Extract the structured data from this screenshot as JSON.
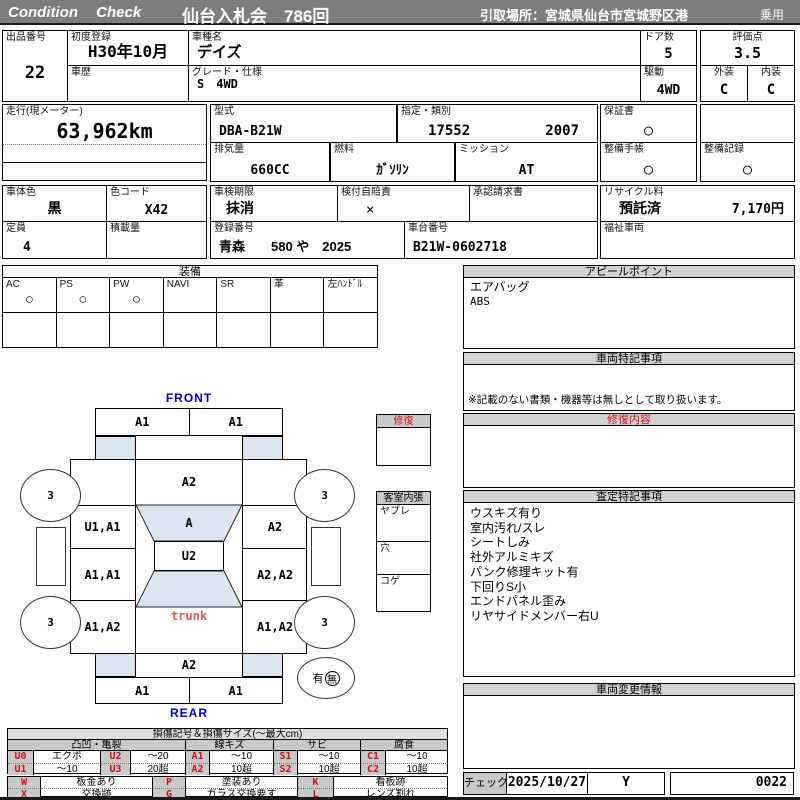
{
  "colors": {
    "header_bg": "#7d7d7d",
    "shade_blue": "#dbe5f1",
    "direction_blue": "#0000cc",
    "accent_red": "#cc1111",
    "cell_gray": "#c9c9c9"
  },
  "header": {
    "brand": "Condition Check",
    "auction": "仙台入札会　786回",
    "pickup": "引取場所：宮城県仙台市宮城野区港",
    "category": "乗用"
  },
  "vehicle": {
    "lot": {
      "label": "出品番号",
      "value": "22"
    },
    "first_registration": {
      "label": "初度登録",
      "value": "H30年10月"
    },
    "model_name": {
      "label": "車種名",
      "value": "デイズ"
    },
    "history": {
      "label": "車歴",
      "value": ""
    },
    "grade": {
      "label": "グレード・仕様",
      "value": "S　4WD"
    },
    "doors": {
      "label": "ドア数",
      "value": "5"
    },
    "score": {
      "label": "評価点",
      "value": "3.5"
    },
    "drive": {
      "label": "駆動",
      "value": "4WD"
    },
    "exterior": {
      "label": "外装",
      "value": "C"
    },
    "interior": {
      "label": "内装",
      "value": "C"
    },
    "mileage": {
      "label": "走行(現メーター)",
      "value": "63,962km"
    },
    "model_code": {
      "label": "型式",
      "value": "DBA-B21W"
    },
    "designation": {
      "label": "指定・類別",
      "value1": "17552",
      "value2": "2007"
    },
    "warranty": {
      "label": "保証書",
      "value": "○"
    },
    "displacement": {
      "label": "排気量",
      "value": "660CC"
    },
    "fuel": {
      "label": "燃料",
      "value": "ｶﾞｿﾘﾝ"
    },
    "mission": {
      "label": "ミッション",
      "value": "AT"
    },
    "maintenance_book": {
      "label": "整備手帳",
      "value": "○"
    },
    "maintenance_record": {
      "label": "整備記録",
      "value": "○"
    },
    "body_color": {
      "label": "車体色",
      "value": "黒"
    },
    "color_code": {
      "label": "色コード",
      "value": "X42"
    },
    "inspection_expiry": {
      "label": "車検期限",
      "value": "抹消"
    },
    "liability_insurance": {
      "label": "検付自賠責",
      "value": "×"
    },
    "approval_request": {
      "label": "承認請求書",
      "value": ""
    },
    "recycle": {
      "label": "リサイクル料",
      "status": "預託済",
      "fee": "7,170円"
    },
    "seating": {
      "label": "定員",
      "value": "4"
    },
    "load_capacity": {
      "label": "積載量",
      "value": ""
    },
    "registration_no": {
      "label": "登録番号",
      "value": "青森　　580 や　2025"
    },
    "chassis_no": {
      "label": "車台番号",
      "value": "B21W-0602718"
    },
    "welfare": {
      "label": "福祉車両",
      "value": ""
    }
  },
  "equipment": {
    "title": "装備",
    "items": [
      {
        "label": "AC",
        "mark": "○"
      },
      {
        "label": "PS",
        "mark": "○"
      },
      {
        "label": "PW",
        "mark": "○"
      },
      {
        "label": "NAVI",
        "mark": ""
      },
      {
        "label": "SR",
        "mark": ""
      },
      {
        "label": "革",
        "mark": ""
      },
      {
        "label": "左ﾊﾝﾄﾞﾙ",
        "mark": ""
      }
    ]
  },
  "panels": {
    "appeal": {
      "title": "アピールポイント",
      "line1": "エアバッグ",
      "line2": "ABS"
    },
    "special_notes": {
      "title": "車両特記事項",
      "note": "※記載のない書類・機器等は無しとして取り扱います。"
    },
    "repair": {
      "title": "修復内容"
    },
    "assessment": {
      "title": "査定特記事項",
      "lines": [
        "ウスキズ有り",
        "室内汚れ/スレ",
        "シートしみ",
        "社外アルミキズ",
        "パンク修理キット有",
        "下回りS小",
        "エンドパネル歪み",
        "リヤサイドメンバー右U"
      ]
    },
    "change_info": {
      "title": "車両変更情報"
    },
    "check": {
      "label": "チェック",
      "date": "2025/10/27",
      "inspector": "Y",
      "sheet_no": "0022"
    }
  },
  "diagram": {
    "front": "FRONT",
    "rear": "REAR",
    "trunk": "trunk",
    "front_bumper_left": "A1",
    "front_bumper_right": "A1",
    "hood": "A2",
    "windshield": "A",
    "roof": "U2",
    "tailgate": "A2",
    "rear_bumper_left": "A1",
    "rear_bumper_right": "A1",
    "left_panels": [
      "U1,A1",
      "A1,A1",
      "A1,A2"
    ],
    "right_panels": [
      "A2",
      "A2,A2",
      "A1,A2"
    ],
    "tires": {
      "front_left": "3",
      "front_right": "3",
      "rear_left": "3",
      "rear_right": "3"
    },
    "spare": {
      "has": "有",
      "none": "無"
    },
    "repair_box_title": "修復",
    "interior_box": {
      "title": "客室内張",
      "rows": [
        "ヤブレ",
        "穴",
        "コゲ"
      ]
    }
  },
  "legend": {
    "title": "損傷記号＆損傷サイズ(～最大cm)",
    "categories": [
      "凸凹・亀裂",
      "線キズ",
      "サビ",
      "腐食"
    ],
    "row1": [
      "U0",
      "エクボ",
      "U2",
      "～20",
      "A1",
      "～10",
      "S1",
      "～10",
      "C1",
      "～10"
    ],
    "row2": [
      "U1",
      "～10",
      "U3",
      "20超",
      "A2",
      "10超",
      "S2",
      "10超",
      "C2",
      "10超"
    ],
    "row3": [
      "W",
      "板金あり",
      "P",
      "塗装あり",
      "K",
      "看板跡"
    ],
    "row4": [
      "X",
      "交換跡",
      "G",
      "ガラス交換要す",
      "L",
      "レンズ割れ"
    ]
  }
}
